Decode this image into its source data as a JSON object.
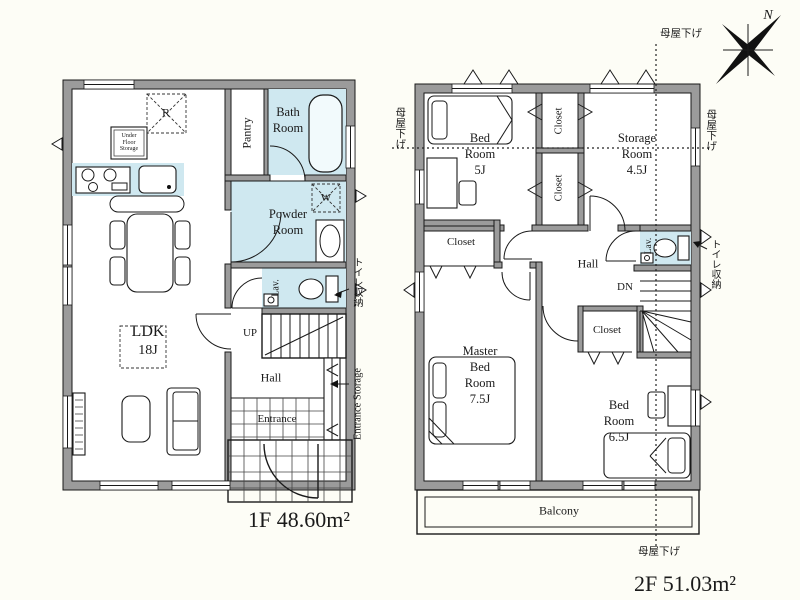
{
  "compass": {
    "north": "N"
  },
  "f1": {
    "area_label": "1F 48.60m²",
    "ldk_name": "LDK",
    "ldk_size": "18J",
    "bath_1": "Bath",
    "bath_2": "Room",
    "pantry": "Pantry",
    "powder_1": "Powder",
    "powder_2": "Room",
    "lav": "Lav.",
    "up": "UP",
    "hall": "Hall",
    "entrance": "Entrance",
    "entrance_storage": "Entrance Storage",
    "toilet_storage": "トイレ収納",
    "ufs_1": "Under",
    "ufs_2": "Floor",
    "ufs_3": "Storage",
    "fridge": "R",
    "washer": "W"
  },
  "f2": {
    "area_label": "2F 51.03m²",
    "bed5_1": "Bed",
    "bed5_2": "Room",
    "bed5_3": "5J",
    "storage_1": "Storage",
    "storage_2": "Room",
    "storage_3": "4.5J",
    "master_1": "Master",
    "master_2": "Bed",
    "master_3": "Room",
    "master_4": "7.5J",
    "bed65_1": "Bed",
    "bed65_2": "Room",
    "bed65_3": "6.5J",
    "hall": "Hall",
    "dn": "DN",
    "lav": "Lav.",
    "balcony": "Balcony",
    "closet_a": "Closet",
    "closet_b": "Closet",
    "closet_c": "Closet",
    "closet_d": "Closet",
    "toilet_storage": "トイレ収納",
    "omoya_top": "母屋下げ",
    "omoya_bottom": "母屋下げ",
    "omoya_left": "母屋下げ",
    "omoya_right": "母屋下げ"
  },
  "colors": {
    "wet_area": "#cfe8f0",
    "wall_fill": "#9b9b9b",
    "line": "#1a1a1a",
    "paper": "#fdfdf6"
  }
}
